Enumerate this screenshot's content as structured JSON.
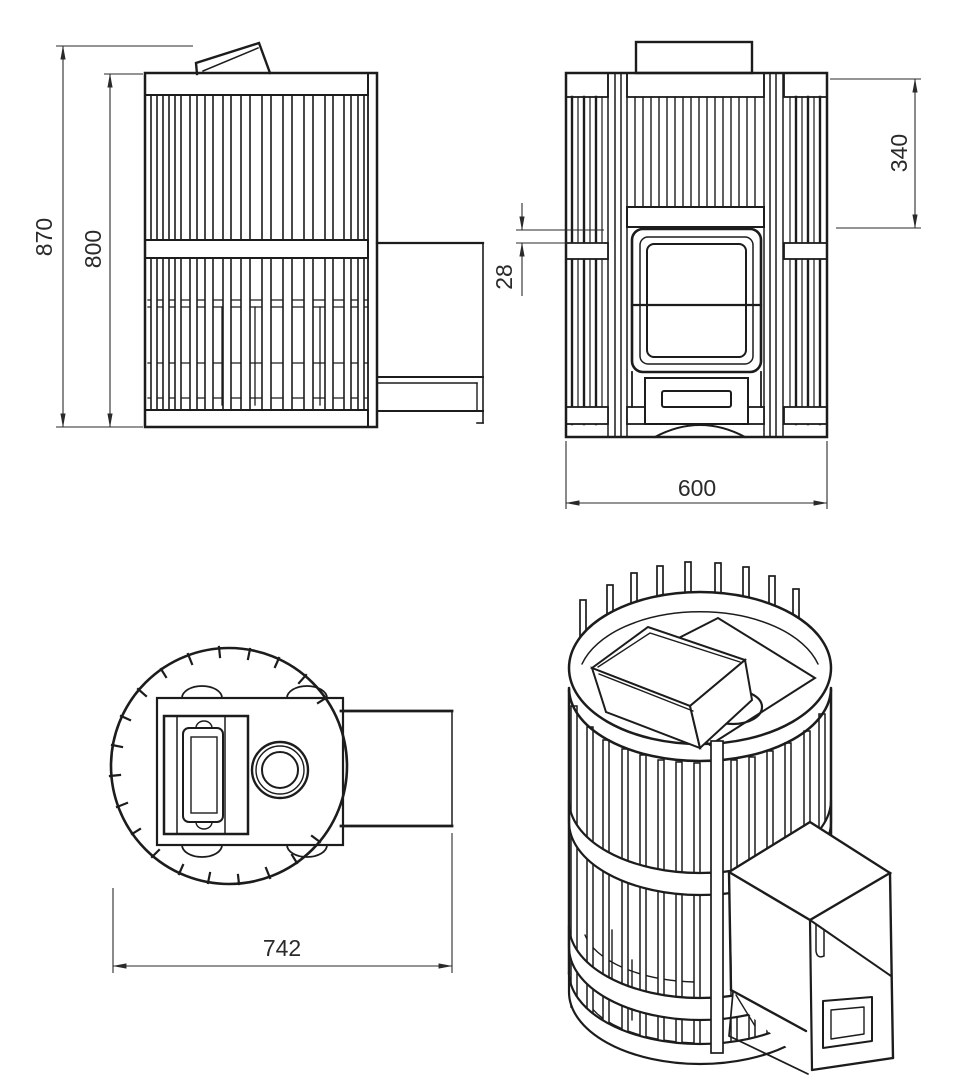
{
  "drawing": {
    "title": "Sauna stove technical drawing - four views",
    "views": {
      "side_view": "side elevation",
      "front_view": "front elevation",
      "top_view": "plan view",
      "iso_view": "isometric view"
    },
    "dimensions": {
      "total_height": "870",
      "cage_height": "800",
      "top_to_door_offset": "340",
      "door_band_gap": "28",
      "front_width": "600",
      "overall_depth": "742"
    },
    "colors": {
      "line": "#1c1c1c",
      "dimension_line": "#2a2a2a",
      "background": "#ffffff"
    }
  }
}
